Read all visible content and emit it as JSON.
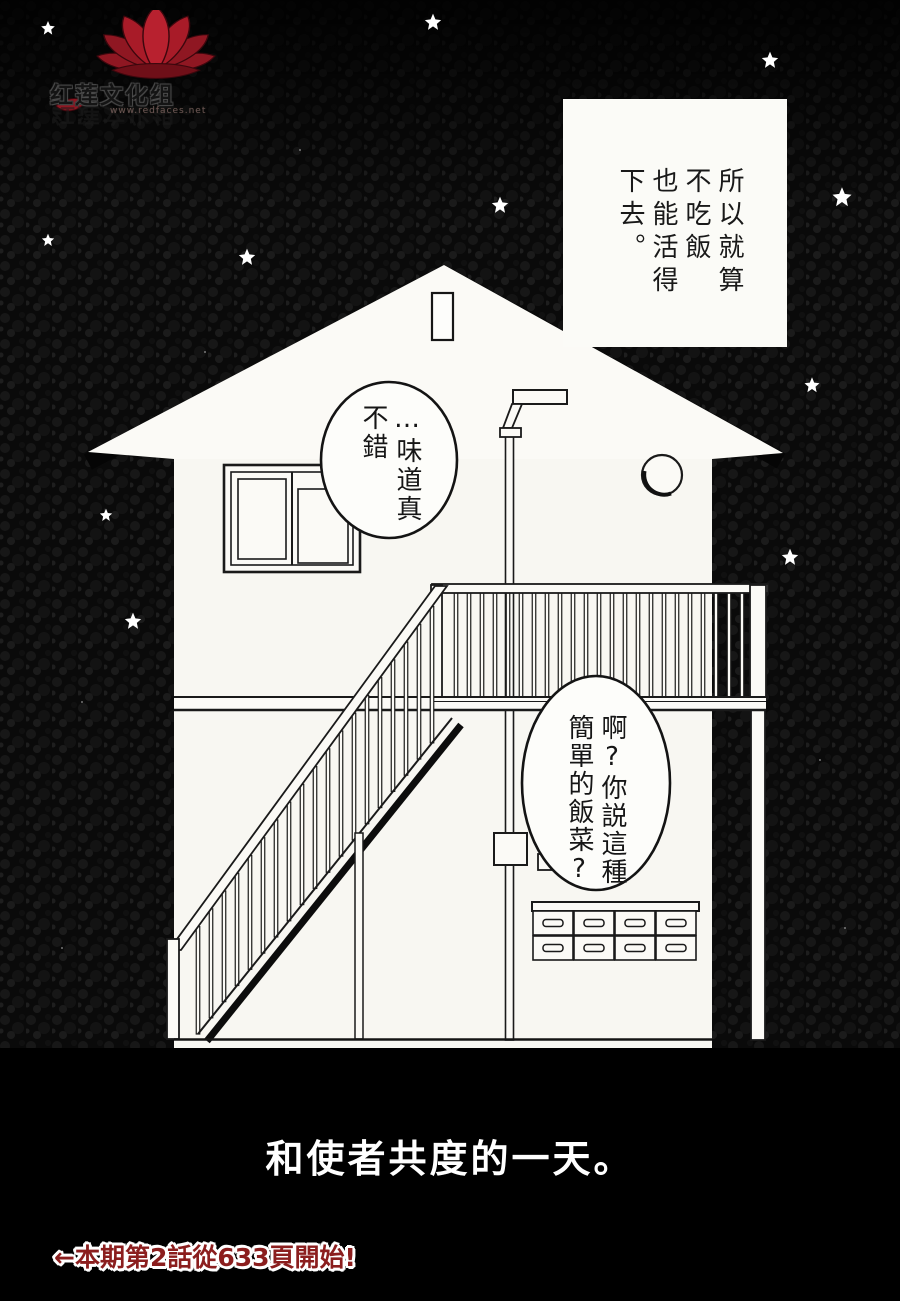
{
  "watermark": {
    "group_name": "红莲文化组",
    "url": "www.redfaces.net",
    "flower_color": "#8f1722"
  },
  "caption": {
    "text": "所以就算\n不吃飯\n也能活得\n下去。"
  },
  "bubbles": {
    "bubble1": "…味道真\n不錯",
    "bubble2": "啊?你説這種\n簡單的飯菜?"
  },
  "title": {
    "text": "和使者共度的一天。",
    "color": "#ffffff"
  },
  "footer": {
    "note": "←本期第2話從633頁開始!",
    "text_color": "#8b1e1e",
    "outline_color": "#ffffff"
  },
  "scene_colors": {
    "sky": "#0a0a0a",
    "house_white": "#f8f7f2",
    "ink": "#1a1a1a",
    "bottom_panel": "#000000"
  }
}
